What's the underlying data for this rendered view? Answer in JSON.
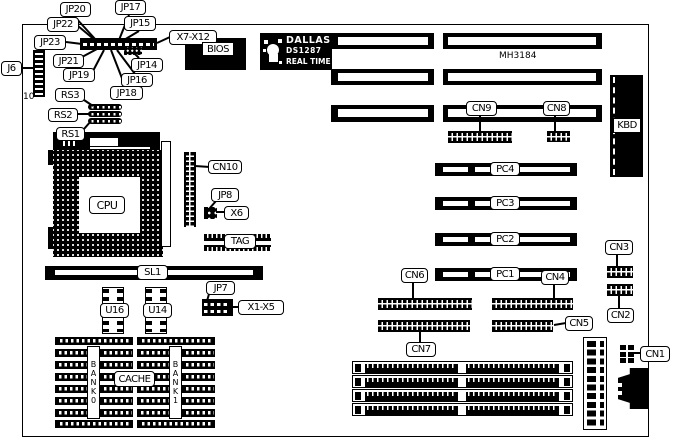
{
  "board": {
    "model": "MH3184",
    "j6_pins": "10"
  },
  "dallas_chip": {
    "brand": "DALLAS",
    "part": "DS1287",
    "type": "REAL TIME"
  },
  "labels": {
    "j6": "J6",
    "jp20": "JP20",
    "jp22": "JP22",
    "jp23": "JP23",
    "jp21": "JP21",
    "jp19": "JP19",
    "jp18": "JP18",
    "jp17": "JP17",
    "jp15": "JP15",
    "jp16": "JP16",
    "jp14": "JP14",
    "x7_x12": "X7-X12",
    "bios": "BIOS",
    "rs3": "RS3",
    "rs2": "RS2",
    "rs1": "RS1",
    "cpu": "CPU",
    "cn10": "CN10",
    "jp8": "JP8",
    "x6": "X6",
    "tag": "TAG",
    "sl1": "SL1",
    "jp7": "JP7",
    "x1_x5": "X1-X5",
    "u16": "U16",
    "u14": "U14",
    "cache": "CACHE",
    "bank0": "BANK0",
    "bank1": "BANK1",
    "kbd": "KBD",
    "cn9": "CN9",
    "cn8": "CN8",
    "pc4": "PC4",
    "pc3": "PC3",
    "pc2": "PC2",
    "pc1": "PC1",
    "cn6": "CN6",
    "cn4": "CN4",
    "cn3": "CN3",
    "cn2": "CN2",
    "cn5": "CN5",
    "cn7": "CN7",
    "cn1": "CN1"
  }
}
